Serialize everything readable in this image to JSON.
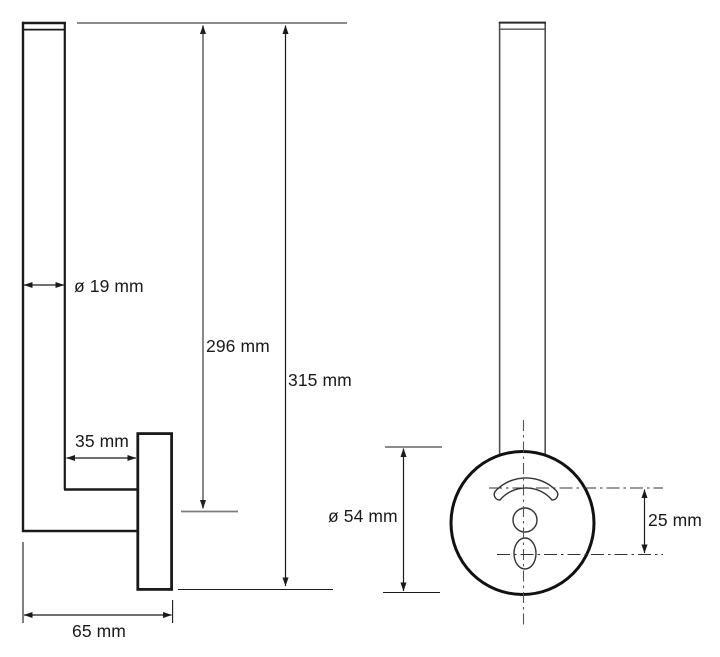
{
  "drawing": {
    "side_view": {
      "dimensions": {
        "tube_diameter": "ø 19 mm",
        "height_to_arm": "296 mm",
        "overall_height": "315 mm",
        "arm_offset": "35 mm",
        "overall_depth": "65 mm"
      }
    },
    "front_view": {
      "dimensions": {
        "plate_diameter": "ø 54 mm",
        "hole_spacing": "25 mm"
      }
    },
    "colors": {
      "outline": "#1a1a1a",
      "dim_line_gray": "#7b7b7b",
      "centerline": "#555555",
      "background": "#ffffff"
    }
  }
}
